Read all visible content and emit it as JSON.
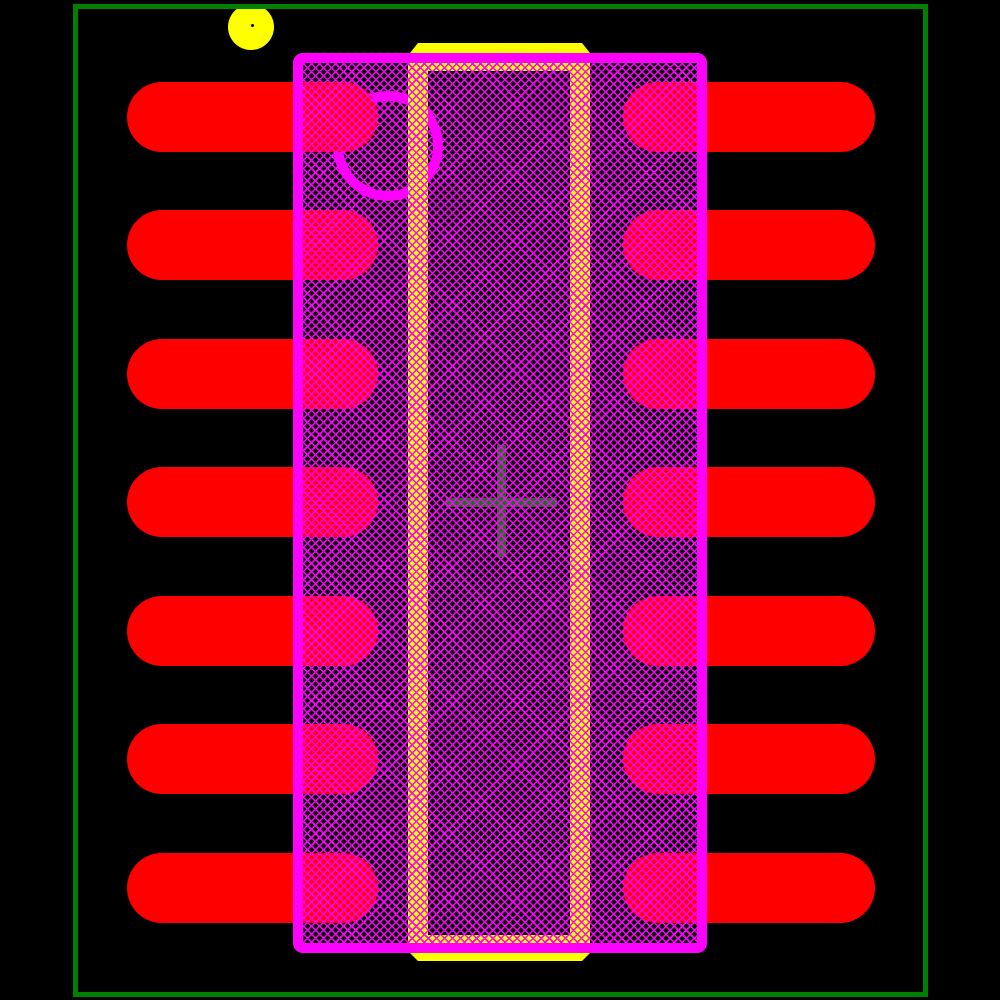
{
  "app": {
    "type": "pcb-footprint-viewer-canvas",
    "background": "#000000"
  },
  "colors": {
    "background": "#000000",
    "copper_pad": "#FF0000",
    "silkscreen": "#FFFF00",
    "assembly": "#FF00FF",
    "courtyard": "#008000",
    "origin": "#0D7A0D",
    "pin1_dot_center": "#000000"
  },
  "layers": {
    "courtyard_outline": {
      "x": 73,
      "y": 4,
      "width": 855,
      "height": 993,
      "stroke": 5
    },
    "pin1_silkscreen_dot": {
      "cx": 251,
      "cy": 27,
      "r": 23,
      "center_dot_r": 1.5,
      "center_dot_x": 252,
      "center_dot_y": 25
    },
    "assembly_body": {
      "x": 293,
      "y": 53,
      "width": 414,
      "height": 900,
      "stroke": 10,
      "corner_radius": 10
    },
    "body_hatch": {
      "x": 303,
      "y": 63,
      "width": 394,
      "height": 880,
      "period": 5.7,
      "line_width": 1.5
    },
    "assembly_pin1_ring": {
      "cx": 388,
      "cy": 146,
      "outer_r": 55,
      "stroke": 10
    },
    "silkscreen_frame": {
      "x": 408,
      "y": 63,
      "width": 182,
      "height": 880,
      "side_width": 20,
      "top_height": 8,
      "bottom_height": 8
    },
    "silkscreen_top_bar": {
      "x": 410,
      "y": 43,
      "width": 180,
      "height": 10,
      "chamfer": 8
    },
    "silkscreen_bottom_bar": {
      "x": 410,
      "y": 953,
      "width": 180,
      "height": 8,
      "chamfer": 8
    },
    "origin_cross": {
      "h": {
        "x": 446,
        "y": 498,
        "width": 111,
        "height": 9
      },
      "v": {
        "x": 497,
        "y": 445,
        "width": 9,
        "height": 112
      }
    },
    "pads": {
      "height": 70,
      "row_centers_y": [
        116.5,
        245,
        373.5,
        502,
        630.5,
        759,
        887.5
      ],
      "left": {
        "x": 127,
        "width": 251
      },
      "right": {
        "x": 623,
        "width": 252
      },
      "count": 14
    }
  }
}
